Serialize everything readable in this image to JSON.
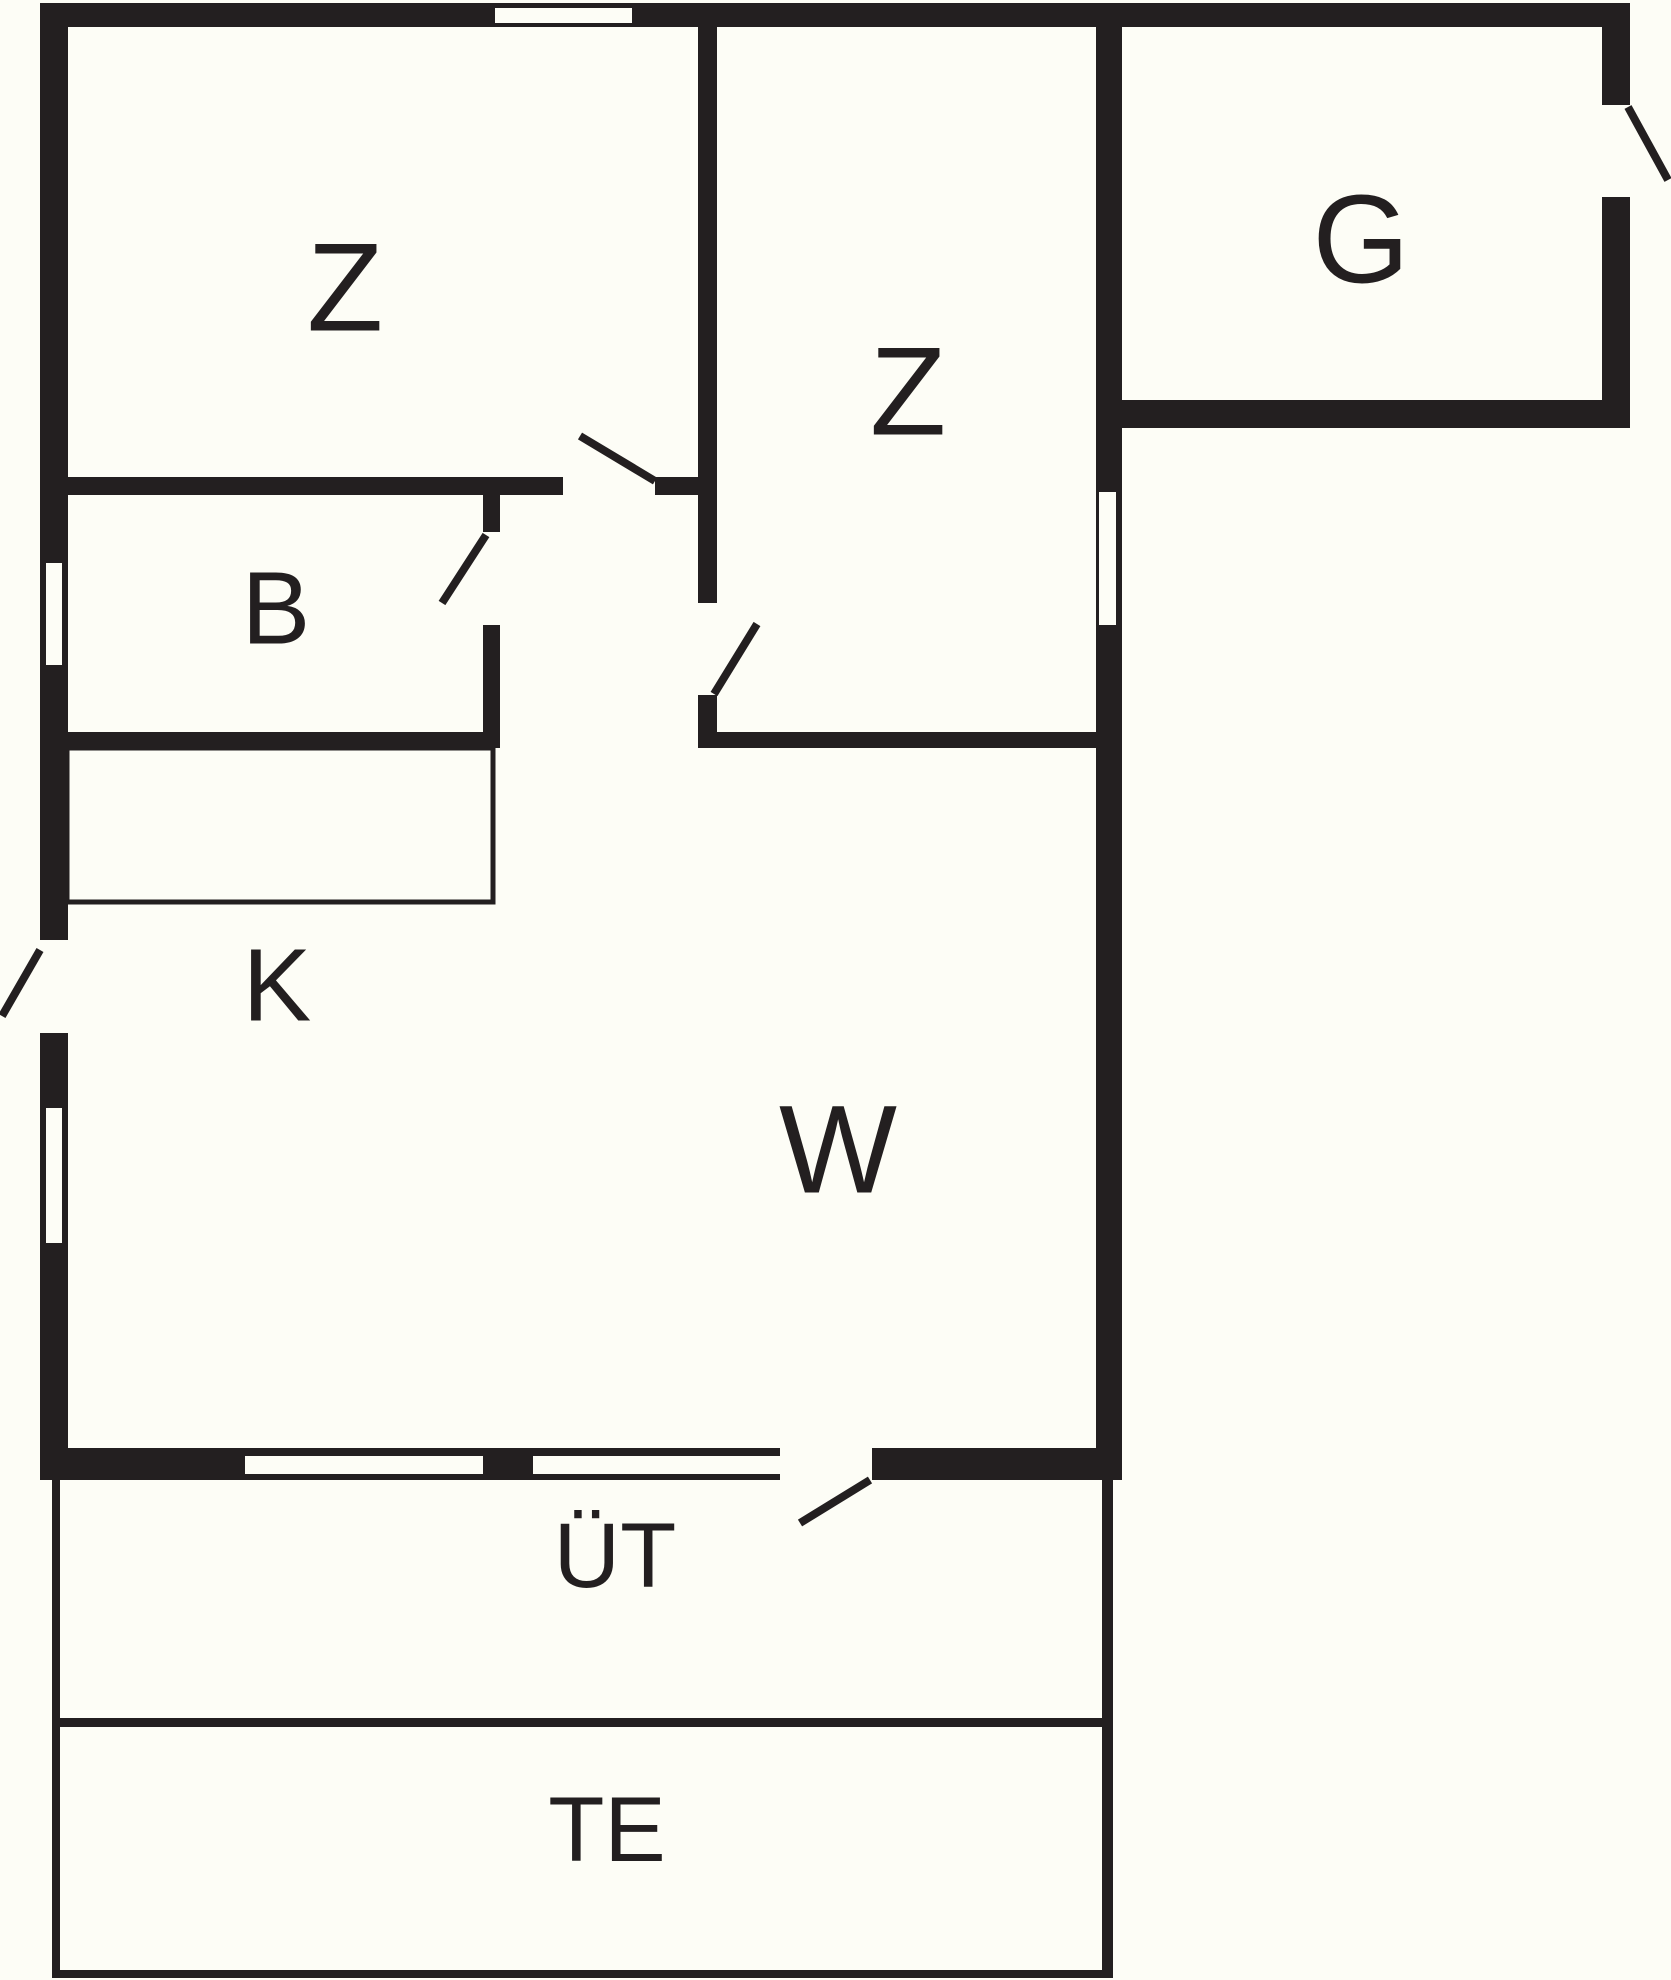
{
  "floorplan": {
    "canvas": {
      "width": 1671,
      "height": 1980
    },
    "background": "#FDFDF6",
    "ink": "#231F20",
    "labels": [
      {
        "name": "room-label-z-left",
        "text": "Z",
        "x": 345,
        "y": 288,
        "size": 125
      },
      {
        "name": "room-label-z-middle",
        "text": "Z",
        "x": 908,
        "y": 392,
        "size": 125
      },
      {
        "name": "room-label-g",
        "text": "G",
        "x": 1361,
        "y": 240,
        "size": 125
      },
      {
        "name": "room-label-b",
        "text": "B",
        "x": 276,
        "y": 608,
        "size": 103
      },
      {
        "name": "room-label-k",
        "text": "K",
        "x": 277,
        "y": 985,
        "size": 103
      },
      {
        "name": "room-label-w",
        "text": "W",
        "x": 838,
        "y": 1150,
        "size": 125
      },
      {
        "name": "room-label-ut",
        "text": "ÜT",
        "x": 615,
        "y": 1556,
        "size": 92
      },
      {
        "name": "room-label-te",
        "text": "TE",
        "x": 607,
        "y": 1830,
        "size": 92
      }
    ],
    "walls": [
      {
        "name": "wall-outer-top",
        "x": 40,
        "y": 3,
        "w": 1590,
        "h": 24
      },
      {
        "name": "wall-outer-left",
        "x": 40,
        "y": 3,
        "w": 28,
        "h": 1477
      },
      {
        "name": "wall-outer-bottom",
        "x": 40,
        "y": 1448,
        "w": 1082,
        "h": 32
      },
      {
        "name": "wall-right-main",
        "x": 1096,
        "y": 27,
        "w": 26,
        "h": 1453
      },
      {
        "name": "wall-g-right",
        "x": 1602,
        "y": 27,
        "w": 28,
        "h": 401
      },
      {
        "name": "wall-g-bottom",
        "x": 1120,
        "y": 400,
        "w": 510,
        "h": 28
      },
      {
        "name": "wall-divider-z-z-upper",
        "x": 698,
        "y": 27,
        "w": 19,
        "h": 576
      },
      {
        "name": "wall-divider-z-z-lower",
        "x": 698,
        "y": 695,
        "w": 19,
        "h": 53
      },
      {
        "name": "wall-z-bottom-left-part",
        "x": 68,
        "y": 477,
        "w": 495,
        "h": 18
      },
      {
        "name": "wall-z-bottom-right-part",
        "x": 655,
        "y": 477,
        "w": 43,
        "h": 18
      },
      {
        "name": "wall-b-right-upper",
        "x": 483,
        "y": 495,
        "w": 17,
        "h": 37
      },
      {
        "name": "wall-b-right-lower",
        "x": 483,
        "y": 625,
        "w": 17,
        "h": 123
      },
      {
        "name": "wall-b-bottom",
        "x": 68,
        "y": 732,
        "w": 432,
        "h": 16
      },
      {
        "name": "wall-z-middle-bottom",
        "x": 717,
        "y": 732,
        "w": 379,
        "h": 16
      }
    ],
    "door_openings": [
      {
        "name": "door-opening-hall-to-z-left",
        "x": 563,
        "y": 477,
        "w": 92,
        "h": 18
      },
      {
        "name": "door-opening-hall-to-b",
        "x": 483,
        "y": 532,
        "w": 17,
        "h": 93
      },
      {
        "name": "door-opening-hall-to-z-middle",
        "x": 698,
        "y": 603,
        "w": 19,
        "h": 92
      },
      {
        "name": "door-opening-left-exterior",
        "x": 40,
        "y": 940,
        "w": 28,
        "h": 93
      },
      {
        "name": "door-opening-g-exterior",
        "x": 1602,
        "y": 105,
        "w": 28,
        "h": 92
      },
      {
        "name": "door-opening-w-to-terrace",
        "x": 780,
        "y": 1448,
        "w": 92,
        "h": 32
      }
    ],
    "windows": [
      {
        "name": "window-top-z-left",
        "x": 495,
        "y": 8,
        "w": 137,
        "h": 15
      },
      {
        "name": "window-left-b",
        "x": 46,
        "y": 563,
        "w": 16,
        "h": 102
      },
      {
        "name": "window-left-w",
        "x": 46,
        "y": 1108,
        "w": 16,
        "h": 135
      },
      {
        "name": "window-right-z-middle",
        "x": 1099,
        "y": 492,
        "w": 17,
        "h": 133
      },
      {
        "name": "window-bottom-1",
        "x": 245,
        "y": 1456,
        "w": 238,
        "h": 18
      },
      {
        "name": "window-bottom-2",
        "x": 533,
        "y": 1456,
        "w": 247,
        "h": 18
      }
    ],
    "outlines": [
      {
        "name": "kitchen-counter",
        "x": 67,
        "y": 748,
        "w": 426,
        "h": 154,
        "stroke_width": 5
      }
    ],
    "thin_lines": [
      {
        "name": "terrace-left-edge",
        "x": 52,
        "y": 1480,
        "w": 8,
        "h": 495
      },
      {
        "name": "terrace-right-edge",
        "x": 1102,
        "y": 1480,
        "w": 11,
        "h": 498
      },
      {
        "name": "terrace-divider",
        "x": 60,
        "y": 1718,
        "w": 1042,
        "h": 9
      },
      {
        "name": "terrace-bottom-edge",
        "x": 52,
        "y": 1970,
        "w": 1061,
        "h": 8
      }
    ],
    "door_swings": [
      {
        "name": "door-swing-z-left",
        "x1": 655,
        "y1": 481,
        "x2": 580,
        "y2": 436
      },
      {
        "name": "door-swing-z-middle",
        "x1": 714,
        "y1": 694,
        "x2": 757,
        "y2": 624
      },
      {
        "name": "door-swing-b",
        "x1": 486,
        "y1": 535,
        "x2": 442,
        "y2": 603
      },
      {
        "name": "door-swing-left-exit",
        "x1": 40,
        "y1": 950,
        "x2": 2,
        "y2": 1016
      },
      {
        "name": "door-swing-g-exit",
        "x1": 1628,
        "y1": 107,
        "x2": 1668,
        "y2": 180
      },
      {
        "name": "door-swing-terrace",
        "x1": 870,
        "y1": 1480,
        "x2": 800,
        "y2": 1523
      }
    ],
    "swing_stroke_width": 8
  }
}
